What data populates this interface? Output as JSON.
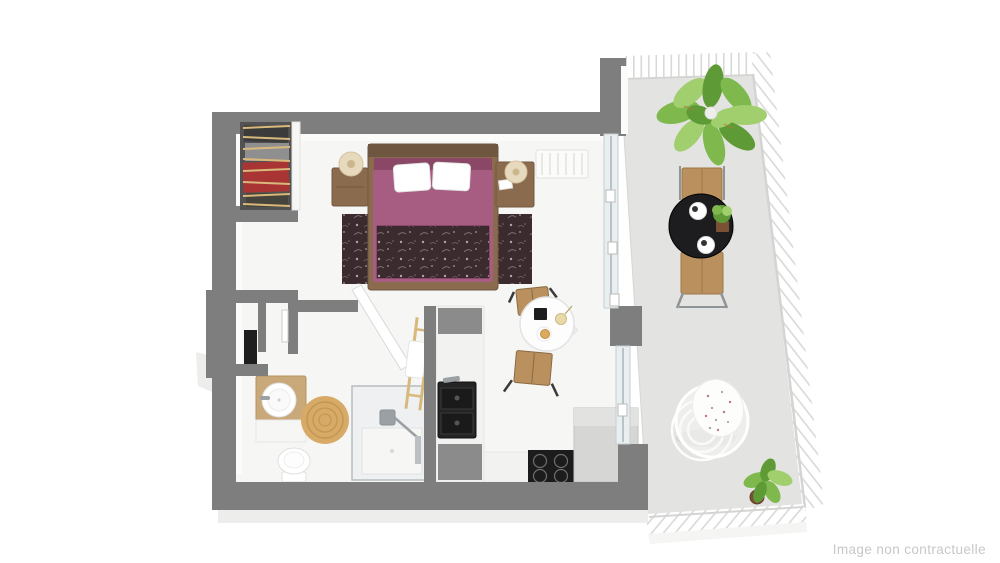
{
  "watermark": {
    "text": "Image non contractuelle"
  },
  "colors": {
    "wall": "#7e7e7e",
    "wall_face": "#fbfbfa",
    "floor": "#f6f6f5",
    "floor_shade": "#ededec",
    "terrace_floor": "#e3e3e1",
    "glass": "#e9eef0",
    "glass_frame": "#9aa6aa",
    "duvet": "#a75d81",
    "duvet_dark": "#8a4766",
    "rug_dark": "#3b2a2e",
    "rug_motif": "#c2aeb0",
    "wood": "#8a6b4e",
    "wood_dark": "#6e5640",
    "wood_light": "#c9a87a",
    "wood_mid": "#b9905e",
    "lamp_shade": "#e6d9bd",
    "jute": "#d7ab67",
    "jute_ring": "#c2974f",
    "appliance_black": "#1c1c1c",
    "steel": "#9aa0a3",
    "fridge_gray": "#d6d6d4",
    "cabinet_open": "#8b8b8b",
    "plant_green": "#7fb94e",
    "plant_green_light": "#a2cf6e",
    "plant_green_dark": "#5e9a36",
    "plant_pot": "#7b5134",
    "table_black": "#1d1d1f",
    "railing_line": "#d9d9d9",
    "closet_dark": "#525252",
    "clothes_red": "#a83434",
    "clothes_gray": "#8f8f8f",
    "clothes_dark": "#3b3b3b",
    "hanger_tan": "#d9b87c",
    "watermark_gray": "#c7c7c7"
  },
  "scene": {
    "type": "3d-floorplan-rendering",
    "rooms": [
      {
        "name": "bedroom-living",
        "furniture": [
          "built-in-wardrobe",
          "double-bed",
          "nightstand-left",
          "nightstand-right",
          "table-lamp-left",
          "table-lamp-right",
          "area-rug",
          "radiator",
          "sliding-glass-wall"
        ]
      },
      {
        "name": "entry",
        "furniture": [
          "front-door"
        ]
      },
      {
        "name": "bathroom",
        "furniture": [
          "vanity-with-round-sink",
          "toilet",
          "round-jute-rug",
          "walk-in-shower",
          "towel-ladder",
          "bathroom-door"
        ]
      },
      {
        "name": "kitchen",
        "furniture": [
          "counter-column",
          "black-sink",
          "open-shelves",
          "induction-hob",
          "tall-unit",
          "bistro-table",
          "stool-top",
          "stool-bottom"
        ]
      },
      {
        "name": "terrace",
        "furniture": [
          "large-potted-plant",
          "outdoor-round-table",
          "outdoor-chair-top",
          "outdoor-chair-bottom",
          "plates",
          "table-plant",
          "hanging-egg-chair",
          "corner-potted-plant",
          "white-railing"
        ]
      }
    ]
  }
}
